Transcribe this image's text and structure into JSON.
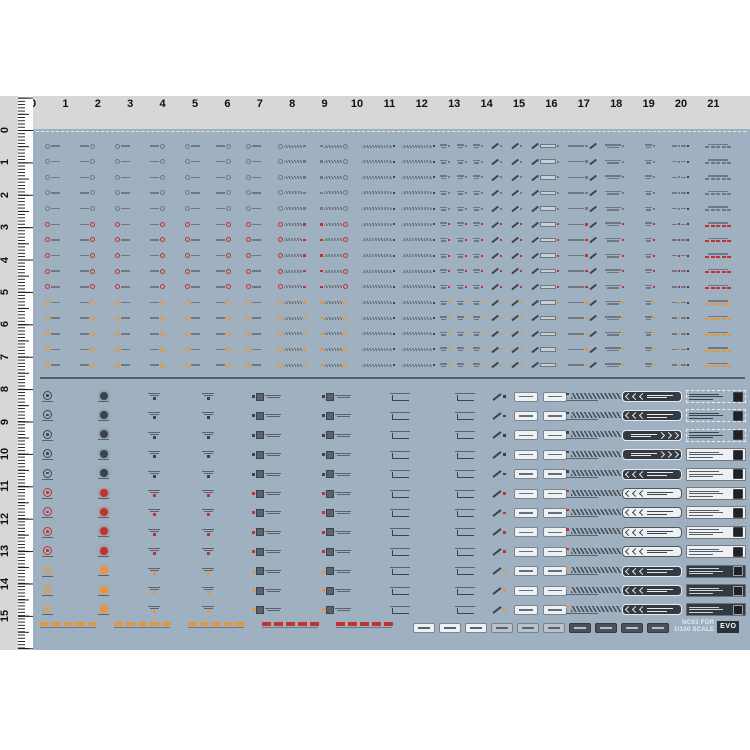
{
  "sheet": {
    "background": "#9fb1c0",
    "page_background": "#ffffff",
    "ruler_background": "#d7d7d7",
    "divider_color": "#565c63"
  },
  "top_ruler": {
    "unit_px": 32.4,
    "origin_x": 33,
    "numbers": [
      "0",
      "1",
      "2",
      "3",
      "4",
      "5",
      "6",
      "7",
      "8",
      "9",
      "10",
      "11",
      "12",
      "13",
      "14",
      "15",
      "16",
      "17",
      "18",
      "19",
      "20",
      "21"
    ]
  },
  "left_ruler": {
    "unit_px": 32.4,
    "origin_y": 34,
    "numbers": [
      "0",
      "1",
      "2",
      "3",
      "4",
      "5",
      "6",
      "7",
      "8",
      "9",
      "10",
      "11",
      "12",
      "13",
      "14",
      "15"
    ]
  },
  "colors": {
    "gray_glyph": "#6e7884",
    "dark_glyph": "#3c434c",
    "red_accent": "#c33030",
    "orange_accent": "#e6953f",
    "white_decal": "#eef1f4",
    "dark_plate": "#343a41"
  },
  "top_section": {
    "row_count": 15,
    "row_start_y": 11,
    "row_spacing": 15.65,
    "row_accents": [
      "gray",
      "gray",
      "gray",
      "gray",
      "gray",
      "red",
      "red",
      "red",
      "red",
      "red",
      "orange",
      "orange",
      "orange",
      "orange",
      "orange"
    ],
    "columns": [
      {
        "x": 12,
        "t": "co",
        "d": "l"
      },
      {
        "x": 47,
        "t": "co",
        "d": "r"
      },
      {
        "x": 82,
        "t": "co",
        "d": "l"
      },
      {
        "x": 117,
        "t": "co",
        "d": "r"
      },
      {
        "x": 152,
        "t": "co",
        "d": "l"
      },
      {
        "x": 183,
        "t": "co",
        "d": "r"
      },
      {
        "x": 213,
        "t": "co",
        "d": "l"
      },
      {
        "x": 245,
        "t": "cw",
        "d": "l"
      },
      {
        "x": 287,
        "t": "cw",
        "d": "r"
      },
      {
        "x": 329,
        "t": "hb"
      },
      {
        "x": 369,
        "t": "hb"
      },
      {
        "x": 407,
        "t": "td"
      },
      {
        "x": 424,
        "t": "td"
      },
      {
        "x": 440,
        "t": "td"
      },
      {
        "x": 458,
        "t": "ar"
      },
      {
        "x": 478,
        "t": "ar"
      },
      {
        "x": 498,
        "t": "ab"
      },
      {
        "x": 535,
        "t": "ba"
      },
      {
        "x": 572,
        "t": "st"
      },
      {
        "x": 612,
        "t": "td"
      },
      {
        "x": 639,
        "t": "tp"
      },
      {
        "x": 672,
        "t": "db"
      }
    ]
  },
  "bottom_section": {
    "row_count": 12,
    "row_start_y": 259,
    "row_spacing": 19.4,
    "row_accents": [
      "dark",
      "dark",
      "dark",
      "dark",
      "dark",
      "red",
      "red",
      "red",
      "red",
      "orange",
      "orange",
      "orange"
    ],
    "columns": [
      {
        "x": 9,
        "t": "r1"
      },
      {
        "x": 65,
        "t": "r2"
      },
      {
        "x": 115,
        "t": "ml"
      },
      {
        "x": 169,
        "t": "ml"
      },
      {
        "x": 219,
        "t": "sq"
      },
      {
        "x": 289,
        "t": "sq"
      },
      {
        "x": 357,
        "t": "br"
      },
      {
        "x": 422,
        "t": "br"
      },
      {
        "x": 459,
        "t": "ad"
      },
      {
        "x": 481,
        "t": "ch"
      },
      {
        "x": 510,
        "t": "ch"
      },
      {
        "x": 533,
        "t": "hz"
      },
      {
        "x": 589,
        "t": "cv"
      },
      {
        "x": 653,
        "t": "pl"
      }
    ]
  },
  "bottom_strip": {
    "y": 493,
    "dash_segments": [
      {
        "x": 7,
        "color": "orange"
      },
      {
        "x": 81,
        "color": "orange"
      },
      {
        "x": 155,
        "color": "orange"
      },
      {
        "x": 229,
        "color": "red"
      },
      {
        "x": 303,
        "color": "red"
      }
    ],
    "chips": [
      {
        "x": 380,
        "style": "white"
      },
      {
        "x": 406,
        "style": "white"
      },
      {
        "x": 432,
        "style": "white"
      },
      {
        "x": 458,
        "style": "gray"
      },
      {
        "x": 484,
        "style": "gray"
      },
      {
        "x": 510,
        "style": "gray"
      },
      {
        "x": 536,
        "style": "dark"
      },
      {
        "x": 562,
        "style": "dark"
      },
      {
        "x": 588,
        "style": "dark"
      },
      {
        "x": 614,
        "style": "dark"
      }
    ]
  },
  "branding": {
    "line1": "NC03 FOR",
    "line2": "1/100 SCALE",
    "logo": "EVO"
  }
}
